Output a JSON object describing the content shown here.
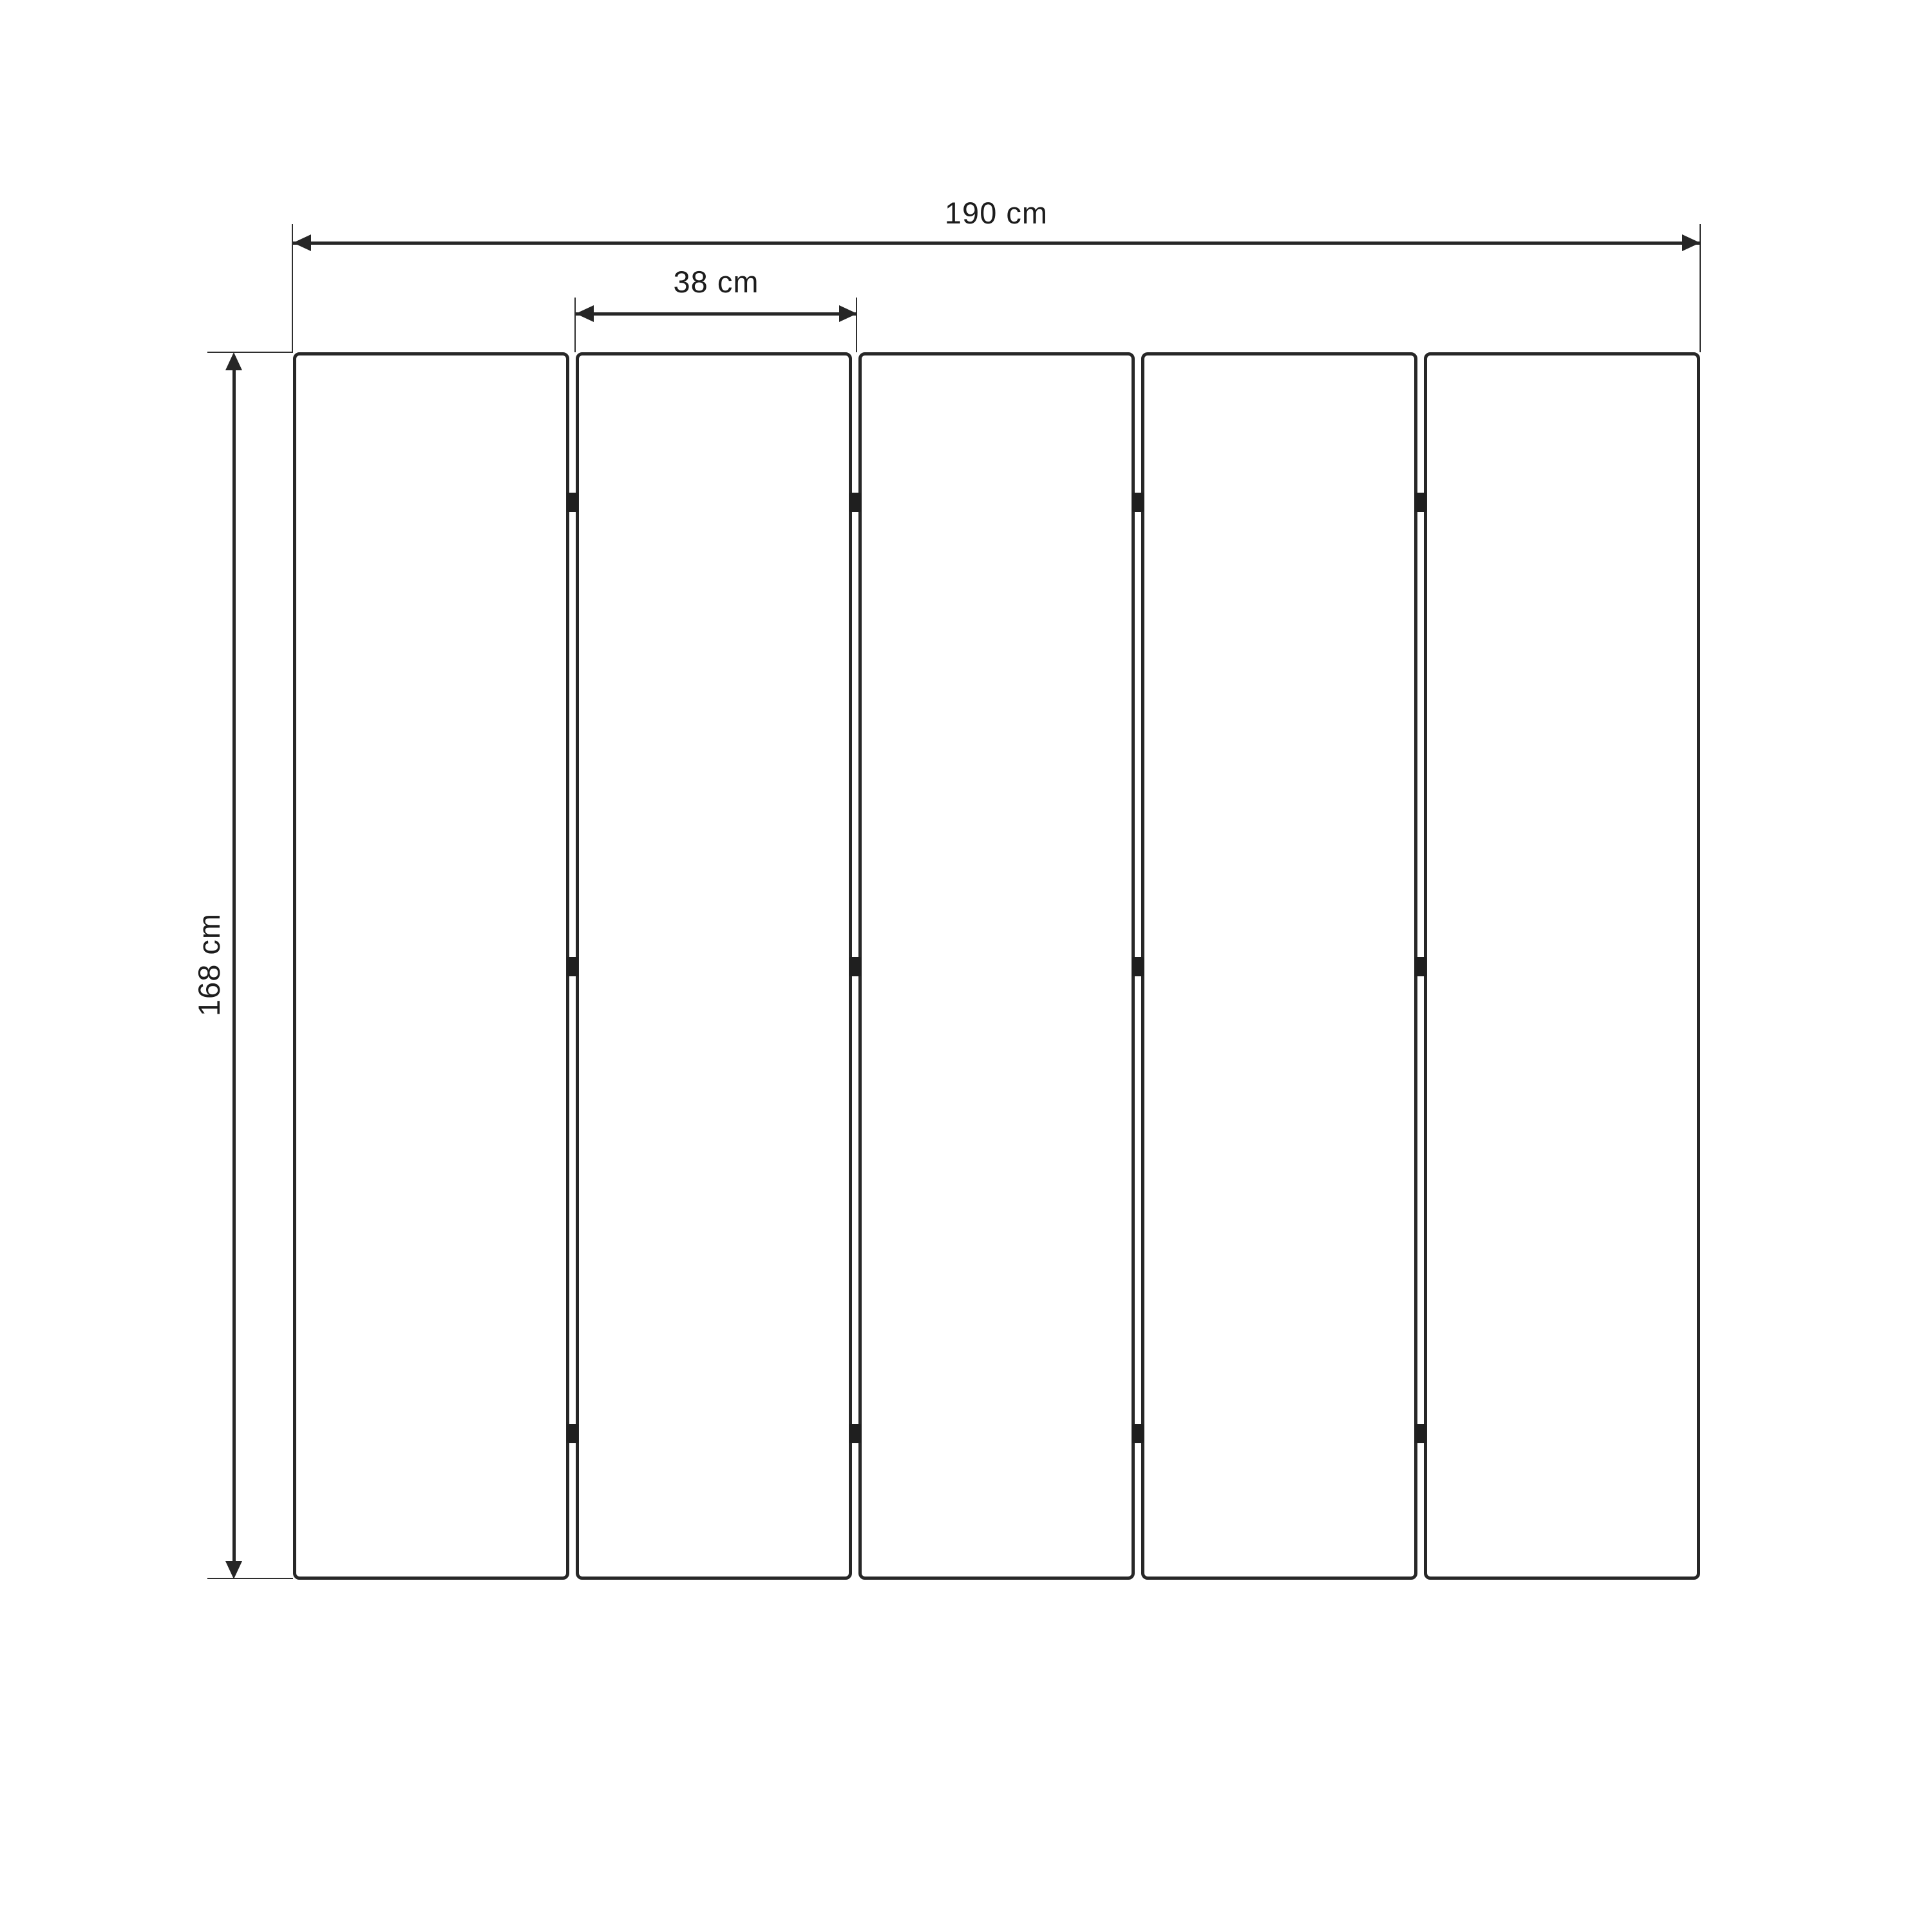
{
  "dimensions": {
    "total_width": "190 cm",
    "panel_width": "38 cm",
    "height": "168 cm"
  },
  "panels": {
    "count": 5,
    "hinges_per_gap": 3
  },
  "colors": {
    "line": "#262626",
    "hinge": "#1f1f1f",
    "text": "#1c1c1c",
    "background": "#ffffff"
  }
}
